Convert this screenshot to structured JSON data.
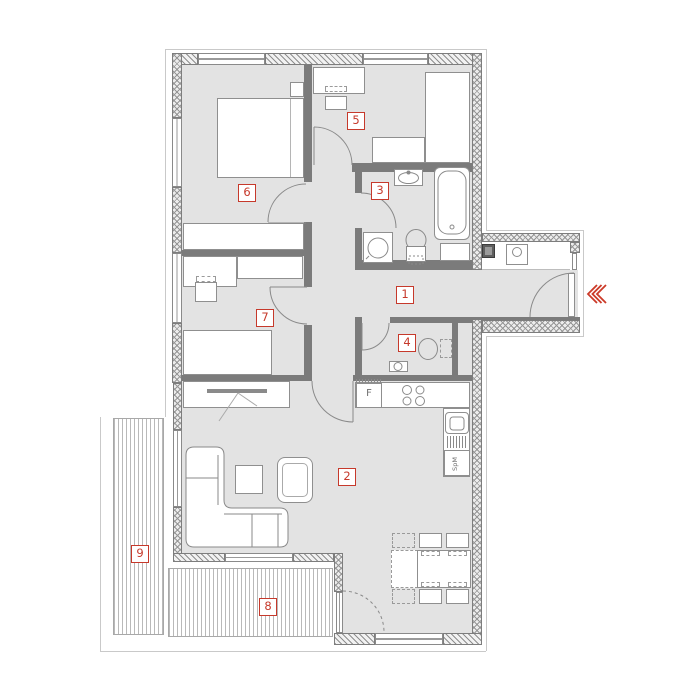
{
  "floorplan": {
    "rooms": [
      {
        "number": "1"
      },
      {
        "number": "2"
      },
      {
        "number": "3"
      },
      {
        "number": "4"
      },
      {
        "number": "5"
      },
      {
        "number": "6"
      },
      {
        "number": "7"
      },
      {
        "number": "8"
      },
      {
        "number": "9"
      }
    ],
    "kitchen": {
      "fridge_label": "F",
      "dishwasher_label": "SpM"
    },
    "entrance": {
      "arrow_icon": "chevron-left-triple",
      "arrow_color": "#cc3a28"
    },
    "colors": {
      "badge": "#c6392b",
      "floor": "#e3e3e3",
      "interior_wall": "#7b7b7b",
      "terrace_stripe": "#b9b9b9"
    }
  }
}
